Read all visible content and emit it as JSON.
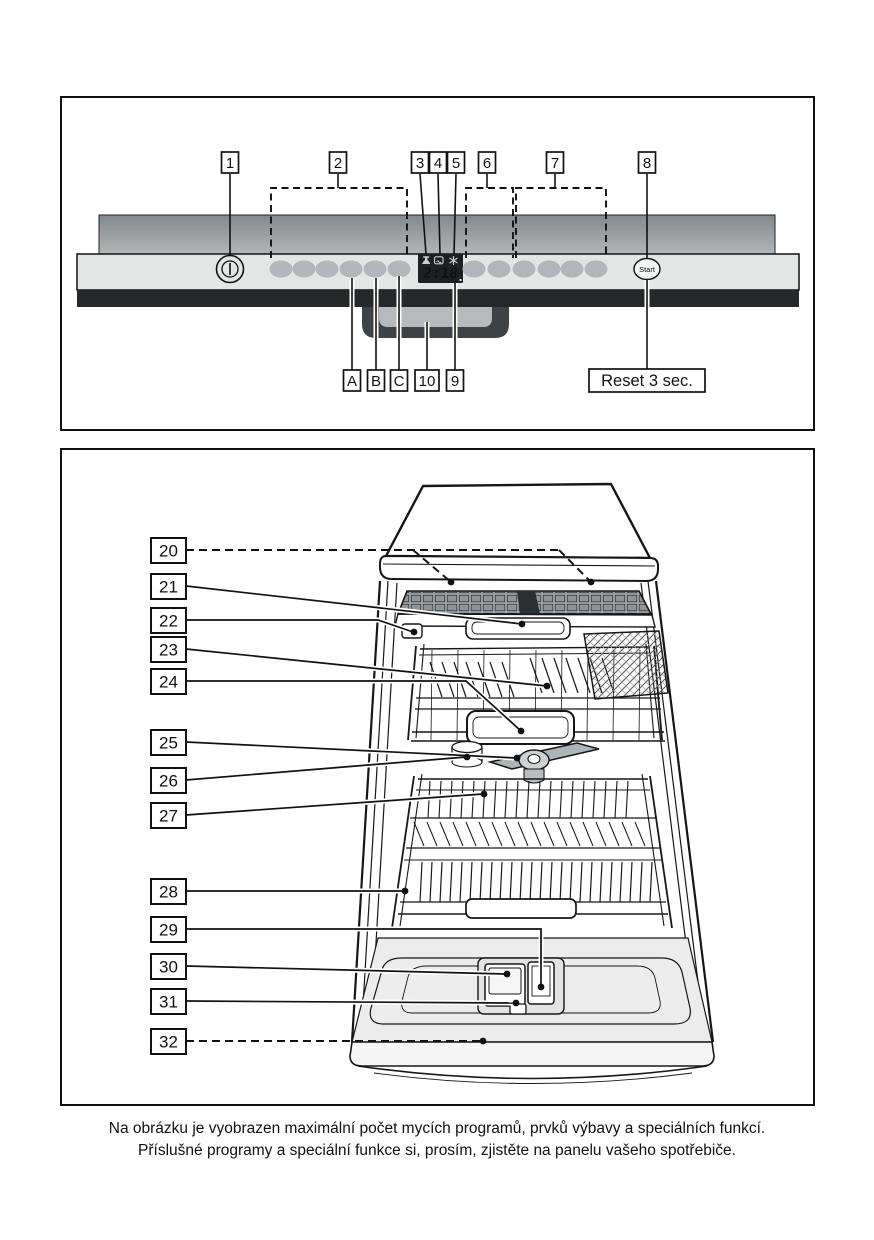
{
  "figure1": {
    "name": "control-panel-diagram",
    "top_labels": [
      "1",
      "2",
      "3",
      "4",
      "5",
      "6",
      "7",
      "8"
    ],
    "bottom_labels": [
      "A",
      "B",
      "C",
      "10",
      "9"
    ],
    "reset_label": "Reset 3 sec.",
    "start_label": "Start",
    "display": {
      "time": "2:18",
      "icons": [
        "water-tap-icon",
        "salt-refill-icon",
        "rinse-aid-icon"
      ]
    }
  },
  "figure2": {
    "name": "dishwasher-interior-diagram",
    "labels": [
      "20",
      "21",
      "22",
      "23",
      "24",
      "25",
      "26",
      "27",
      "28",
      "29",
      "30",
      "31",
      "32"
    ]
  },
  "caption": {
    "line1": "Na obrázku je vyobrazen maximální počet mycích programů, prvků výbavy a speciálních funkcí.",
    "line2": "Příslušné programy a speciální funkce si, prosím, zjistěte na panelu vašeho spotřebiče."
  },
  "colors": {
    "line": "#161616",
    "panel_light": "#e4e6e6",
    "door_band_top": "#83888b",
    "door_band_bottom": "#b2b6b8",
    "dark_band": "#25292b",
    "button_gray": "#b2b6b8",
    "display_bg": "#1c2022",
    "digit_color": "#e6e9e9"
  }
}
